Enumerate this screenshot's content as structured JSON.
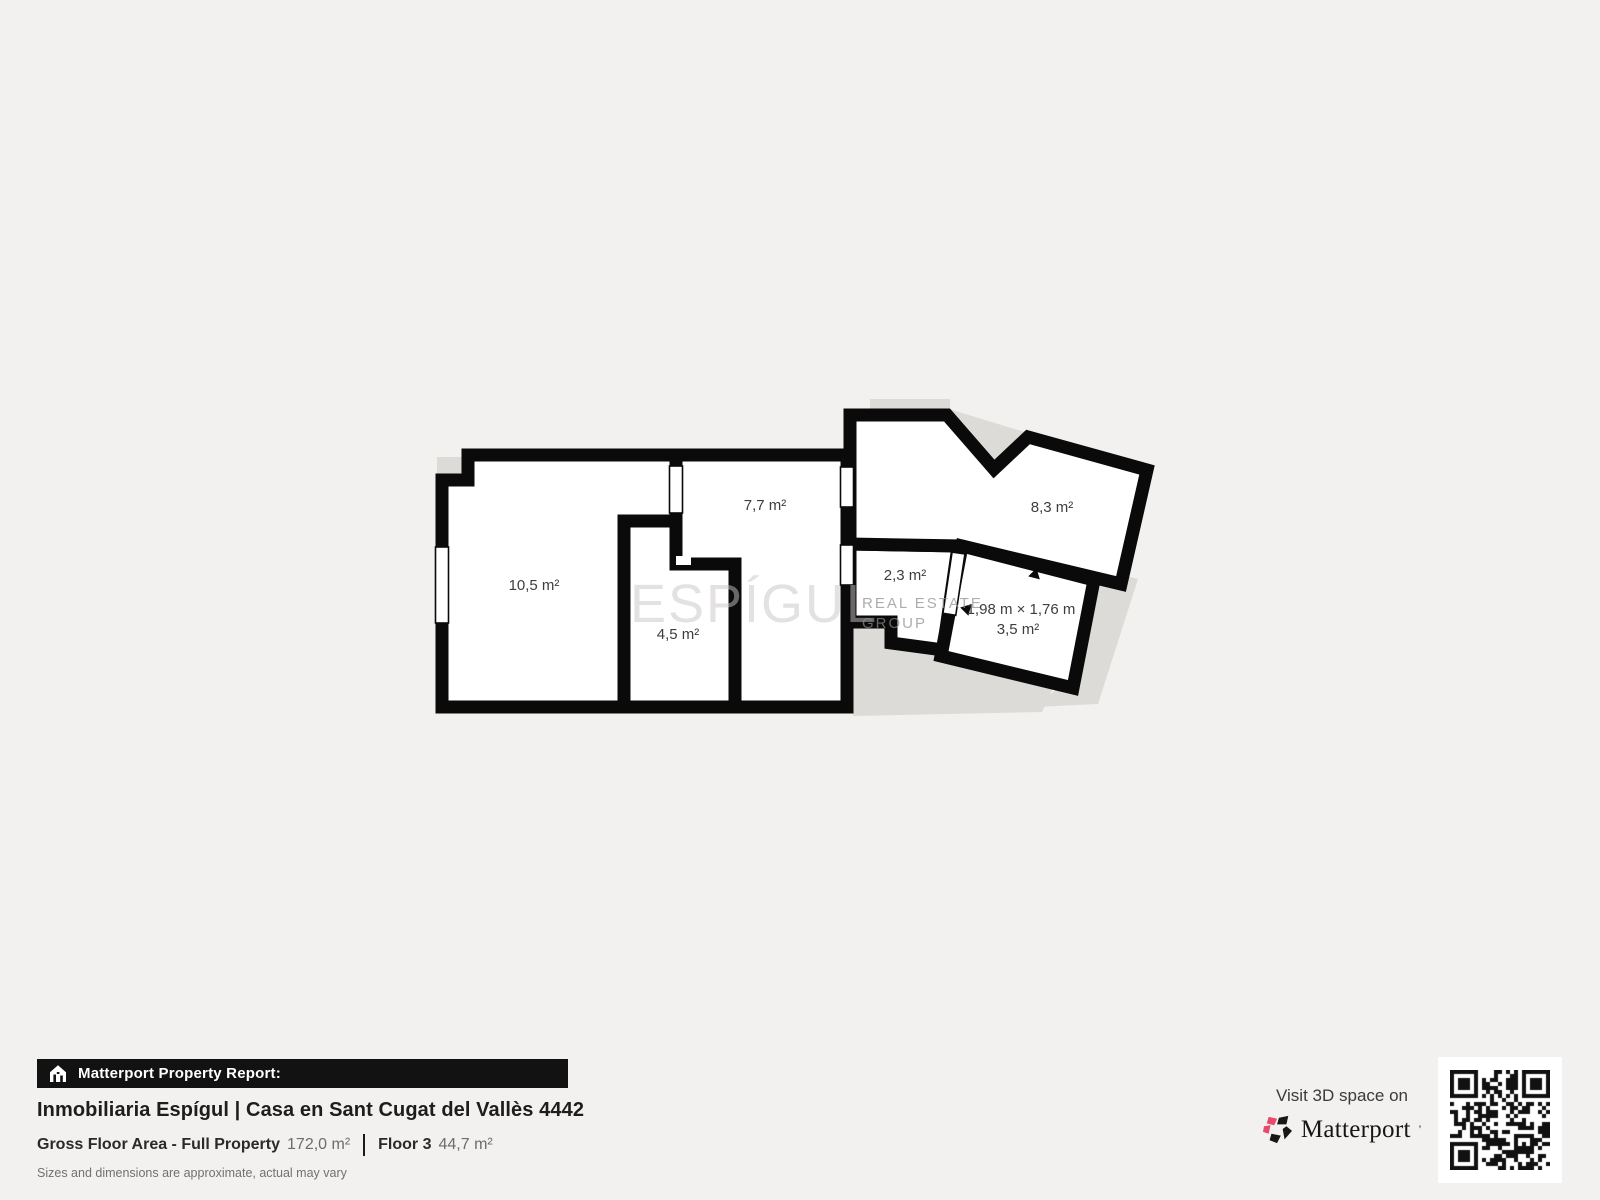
{
  "plan": {
    "rooms": [
      {
        "label": "10,5 m²"
      },
      {
        "label": "7,7 m²"
      },
      {
        "label": "4,5 m²"
      },
      {
        "label": "2,3 m²"
      },
      {
        "label": "8,3 m²"
      },
      {
        "label": "3,5 m²"
      }
    ],
    "dimension_label": "1,98 m × 1,76 m",
    "watermark": {
      "big": "ESPÍGUL",
      "small_line1": "REAL ESTATE",
      "small_line2": "GROUP"
    },
    "colors": {
      "wall": "#0a0a0a",
      "room_fill": "#ffffff",
      "underlay": "#dcdbd8",
      "background": "#f2f1ef"
    }
  },
  "report": {
    "bar_title": "Matterport Property Report:",
    "property_title": "Inmobiliaria Espígul | Casa en Sant Cugat del Vallès 4442",
    "gross_label": "Gross Floor Area - Full Property",
    "gross_value": "172,0 m²",
    "floor_label": "Floor 3",
    "floor_value": "44,7 m²",
    "disclaimer": "Sizes and dimensions are approximate, actual may vary"
  },
  "cta": {
    "visit_text": "Visit 3D space on",
    "brand": "Matterport",
    "brand_pink": "#e8486a"
  }
}
